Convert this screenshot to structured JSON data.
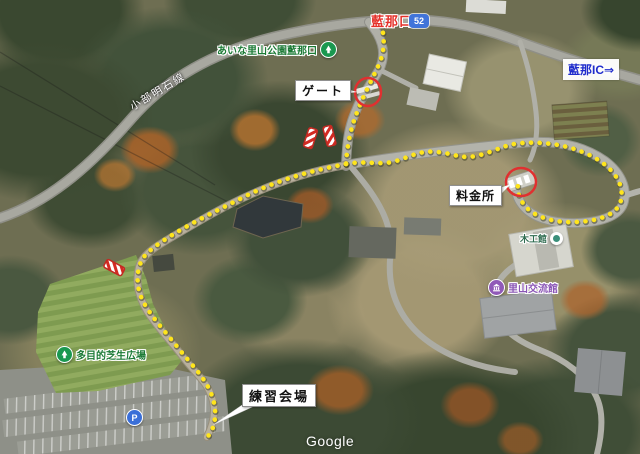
{
  "map": {
    "watermark": "Google",
    "annotations": {
      "entrance_name": "藍那口",
      "route_number": "52",
      "road_name": "小部明石線",
      "ic_label": "藍那IC⇒",
      "gate_label": "ゲート",
      "toll_label": "料金所",
      "venue_label": "練習会場"
    },
    "pois": {
      "park_entrance": "あいな里山公園藍那口",
      "lawn_plaza": "多目的芝生広場",
      "wood_hall": "木工館",
      "community_hall": "里山交流館",
      "parking_glyph": "P"
    },
    "colors": {
      "route_dots": "#ffe51c",
      "annotation_red": "#e03030",
      "poi_green": "#1a9850",
      "poi_purple": "#9059b8",
      "ic_blue": "#1f2ccc",
      "shield_blue": "#4174d9"
    }
  }
}
